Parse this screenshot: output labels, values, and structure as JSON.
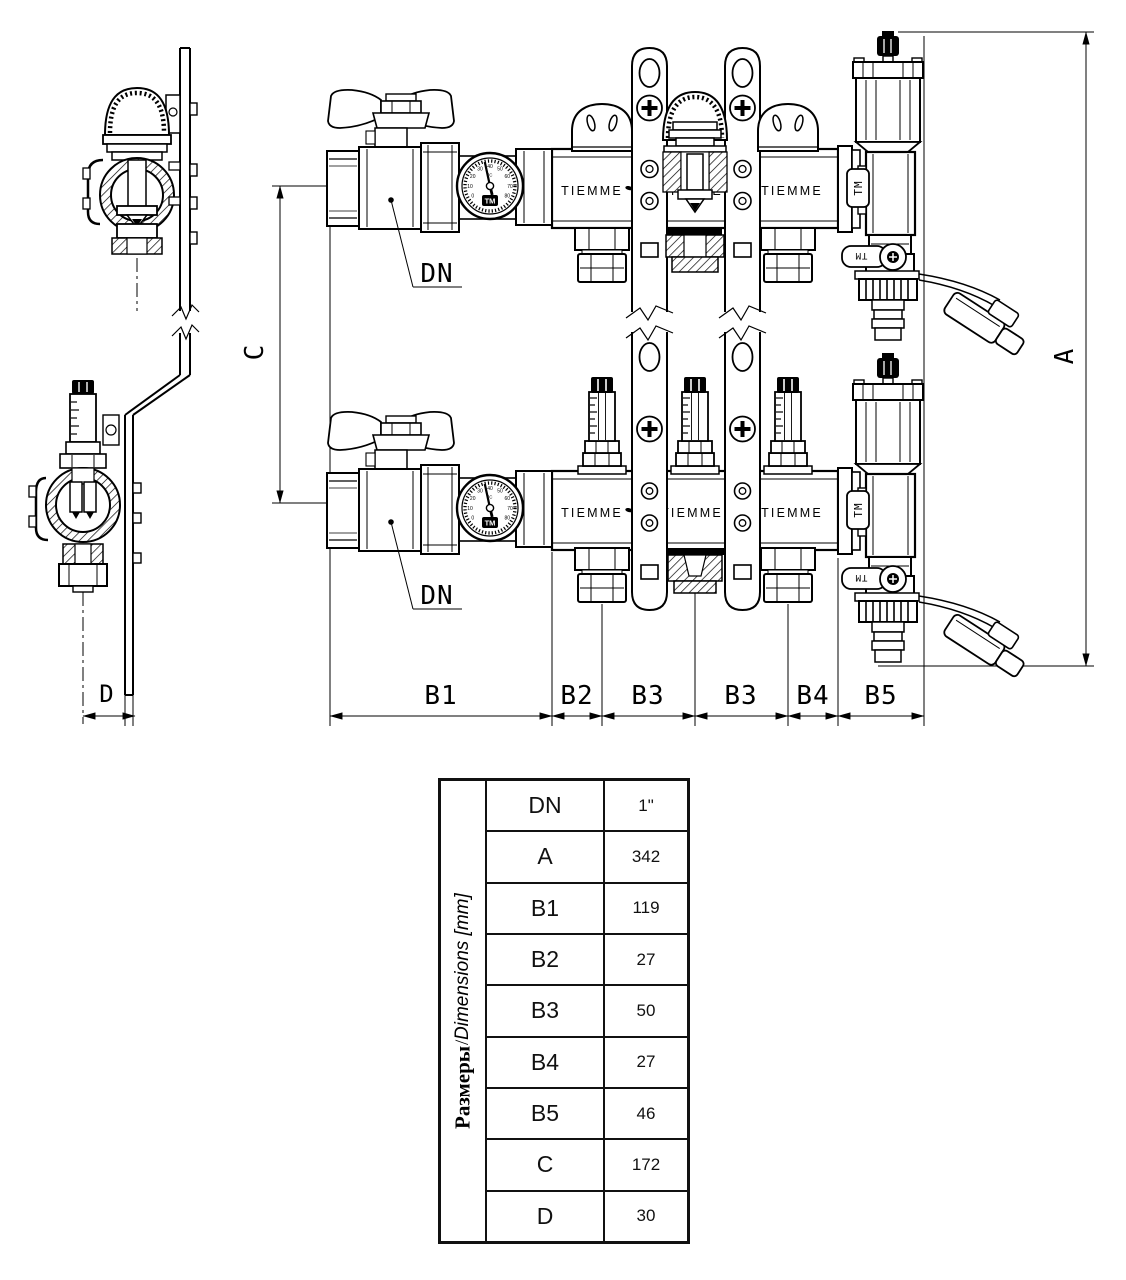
{
  "drawing": {
    "brand": "TIEMME",
    "tm_label": "TM",
    "dn_label": "DN",
    "gauge": {
      "unit": "°C",
      "scale": [
        "0",
        "10",
        "20",
        "30",
        "40",
        "50",
        "60",
        "70",
        "80"
      ]
    },
    "dims": {
      "a": "A",
      "b1": "B1",
      "b2": "B2",
      "b3": "B3",
      "b4": "B4",
      "b5": "B5",
      "c": "C",
      "d": "D"
    }
  },
  "table": {
    "header_ru": "Размеры",
    "header_sep": " / ",
    "header_en": "Dimensions [mm]",
    "rows": [
      {
        "label": "DN",
        "value": "1\""
      },
      {
        "label": "A",
        "value": "342"
      },
      {
        "label": "B1",
        "value": "119"
      },
      {
        "label": "B2",
        "value": "27"
      },
      {
        "label": "B3",
        "value": "50"
      },
      {
        "label": "B4",
        "value": "27"
      },
      {
        "label": "B5",
        "value": "46"
      },
      {
        "label": "C",
        "value": "172"
      },
      {
        "label": "D",
        "value": "30"
      }
    ]
  }
}
